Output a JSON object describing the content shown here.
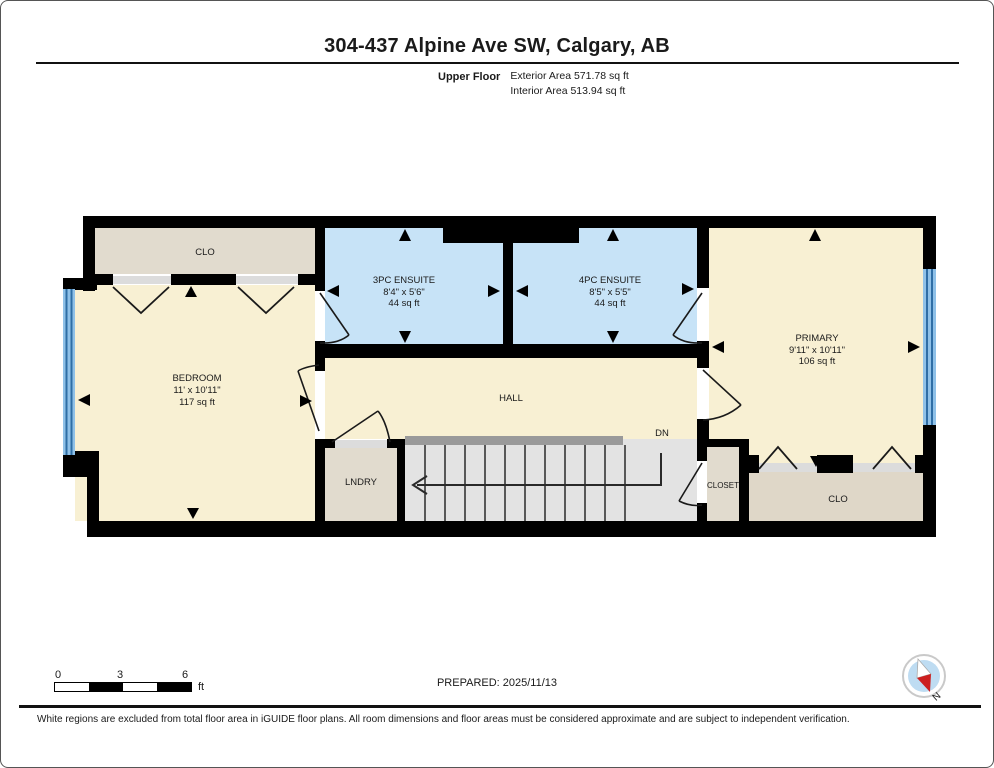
{
  "header": {
    "title": "304-437 Alpine Ave SW, Calgary, AB",
    "floor_label": "Upper Floor",
    "exterior_area": "Exterior Area 571.78 sq ft",
    "interior_area": "Interior Area 513.94 sq ft"
  },
  "plan": {
    "rooms": {
      "clo_top": {
        "name": "CLO"
      },
      "bedroom": {
        "name": "BEDROOM",
        "dims": "11' x 10'11\"",
        "area": "117 sq ft"
      },
      "ensuite_3pc": {
        "name": "3PC ENSUITE",
        "dims": "8'4\" x 5'6\"",
        "area": "44 sq ft"
      },
      "ensuite_4pc": {
        "name": "4PC ENSUITE",
        "dims": "8'5\" x 5'5\"",
        "area": "44 sq ft"
      },
      "primary": {
        "name": "PRIMARY",
        "dims": "9'11\" x 10'11\"",
        "area": "106 sq ft"
      },
      "hall": {
        "name": "HALL"
      },
      "laundry": {
        "name": "LNDRY"
      },
      "closet": {
        "name": "CLOSET"
      },
      "clo_bottom": {
        "name": "CLO"
      }
    },
    "stairs": {
      "direction_label": "DN"
    }
  },
  "colors": {
    "wall": "#000000",
    "floor_cream": "#F8F0D3",
    "floor_blue": "#C7E3F7",
    "floor_beige": "#E1DBCE",
    "floor_beige_dark": "#DFD7C8",
    "floor_stairs": "#E3E3E3",
    "rail": "#9A9A9A",
    "sill": "#DCDCDC",
    "window_blue": "#8FC1E8",
    "window_line": "#2F6EA5",
    "compass_blue": "#BEDCF2",
    "compass_red": "#CC1F1F"
  },
  "scale_bar": {
    "start": "0",
    "mid": "3",
    "end": "6",
    "unit": "ft"
  },
  "footer": {
    "prepared": "PREPARED: 2025/11/13",
    "disclaimer": "White regions are excluded from total floor area in iGUIDE floor plans. All room dimensions and floor areas must be considered approximate and are subject to independent verification.",
    "compass_label": "N"
  }
}
